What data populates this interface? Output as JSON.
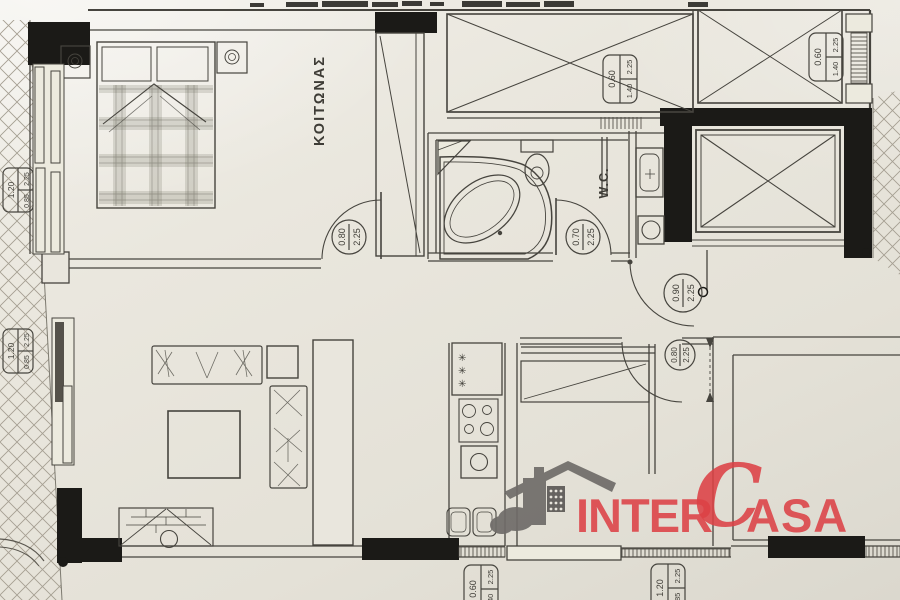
{
  "plan": {
    "rooms": {
      "bedroom_label": "ΚΟΙΤΩΝΑΣ",
      "wc_label": "W.C."
    },
    "door_tags": [
      {
        "loc": "bedroom-door",
        "w": "0.80",
        "h": "2.25"
      },
      {
        "loc": "bathroom-door",
        "w": "0.70",
        "h": "2.25"
      },
      {
        "loc": "entrance-door",
        "w": "0.90",
        "h": "2.25"
      },
      {
        "loc": "kitchen-door",
        "w": "0.80",
        "h": "2.25"
      }
    ],
    "window_tags": [
      {
        "loc": "bath-top-window",
        "w": "0.60",
        "top": "2.25",
        "bottom": "1.40"
      },
      {
        "loc": "shaft-top-window",
        "w": "0.60",
        "top": "2.25",
        "bottom": "1.40"
      },
      {
        "loc": "bedroom-balcony-door",
        "w": "1.20",
        "top": "2.25",
        "bottom": "0.85"
      },
      {
        "loc": "living-balcony-door",
        "w": "1.20",
        "top": "2.25",
        "bottom": "0.85"
      },
      {
        "loc": "kitchen-bottom-window",
        "w": "0.60",
        "top": "2.25",
        "bottom": "1.40"
      },
      {
        "loc": "dining-balcony-door",
        "w": "1.20",
        "top": "2.25",
        "bottom": "0.85"
      }
    ],
    "logo": {
      "inter": "INTER",
      "c": "C",
      "asa": "ASA",
      "red": "#dc4146",
      "gray": "#6f6c69"
    },
    "colors": {
      "paper": "#e8e5dc",
      "ink": "#46443e"
    }
  }
}
